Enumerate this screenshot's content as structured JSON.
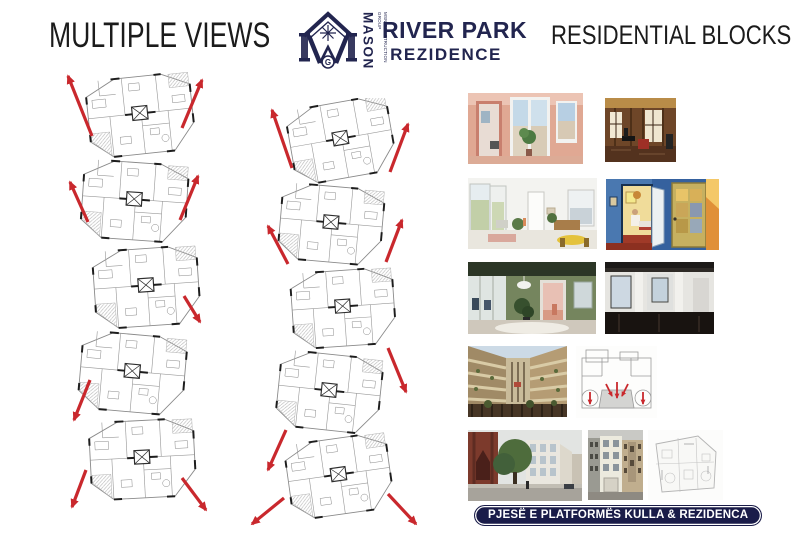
{
  "header": {
    "left_title": "MULTIPLE VIEWS",
    "right_title": "RESIDENTIAL BLOCKS",
    "logo": {
      "vertical_brand": "MASON",
      "vertical_tagline": "MSN CONSTRUCTION GROUP",
      "monogram_letter": "G",
      "name_line1": "RIVER PARK",
      "name_line2": "REZIDENCE"
    }
  },
  "colors": {
    "navy": "#22254f",
    "arrow_red": "#c9282d",
    "banner_bg": "#1a1c49",
    "title_text": "#1b1b1b"
  },
  "plans": {
    "left": {
      "name": "floor-plan-tower-a"
    },
    "right": {
      "name": "floor-plan-tower-b"
    }
  },
  "gallery": {
    "items": [
      {
        "name": "render-terrace-doorway-salmon"
      },
      {
        "name": "photo-wood-panel-lounge"
      },
      {
        "name": "render-white-living-room-balcony"
      },
      {
        "name": "painting-blue-room-yellow-door"
      },
      {
        "name": "render-green-living-room"
      },
      {
        "name": "photo-empty-dark-floor-apartment"
      },
      {
        "name": "photo-brick-courtyard-towers"
      },
      {
        "name": "sketch-entrance-plan-red-arrows"
      },
      {
        "name": "photo-church-street-new-building"
      },
      {
        "name": "photo-modern-infill-facade"
      },
      {
        "name": "drawing-site-floor-plan"
      }
    ]
  },
  "footer": {
    "banner_text": "PJESË E PLATFORMËS KULLA & REZIDENCA"
  }
}
